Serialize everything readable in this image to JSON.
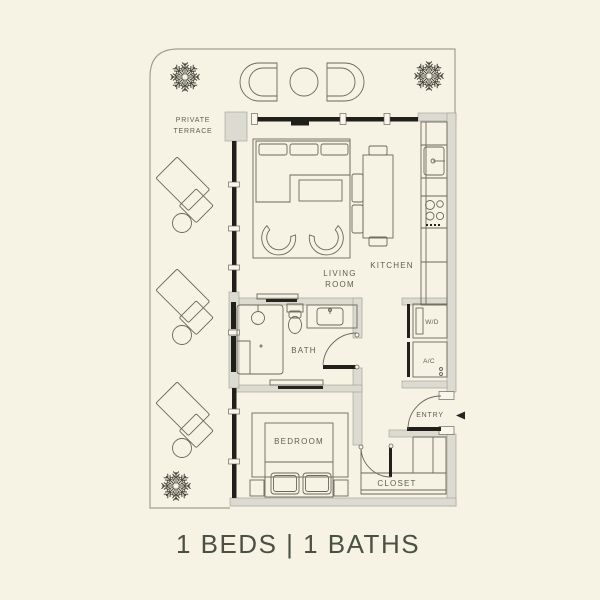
{
  "footer": {
    "summary": "1 BEDS | 1 BATHS"
  },
  "labels": {
    "private_terrace_line1": "PRIVATE",
    "private_terrace_line2": "TERRACE",
    "living_room_line1": "LIVING",
    "living_room_line2": "ROOM",
    "kitchen": "KITCHEN",
    "bath": "BATH",
    "bedroom": "BEDROOM",
    "closet": "CLOSET",
    "entry": "ENTRY",
    "washer_dryer": "W/D",
    "air_conditioning": "A/C"
  },
  "colors": {
    "background": "#f6f3e4",
    "wall_black": "#211f1a",
    "wall_gray_fill": "#dcdbd2",
    "wall_gray_edge": "#aaa79b",
    "furniture_line": "#6b675c",
    "terrace_line": "#a3a093",
    "label_text": "#5c6054",
    "footer_text": "#4b5045"
  }
}
